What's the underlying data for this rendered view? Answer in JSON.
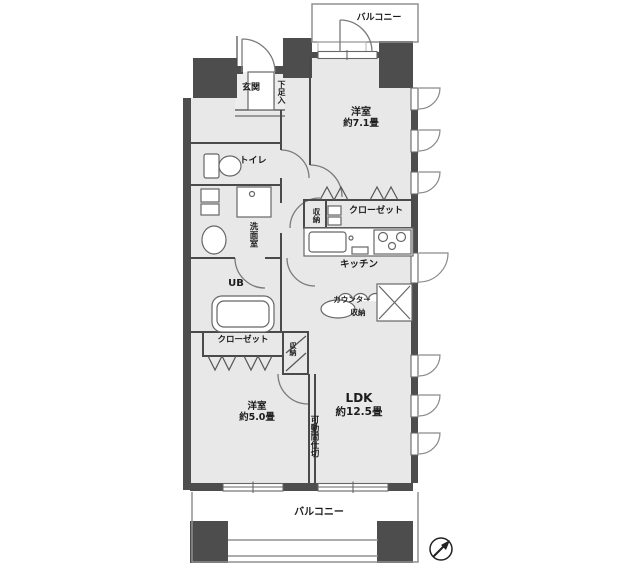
{
  "labels": {
    "balcony_top": "バルコニー",
    "balcony_bottom": "バルコニー",
    "entrance": "玄関",
    "shoe_cabinet": "下足入",
    "toilet": "トイレ",
    "washroom": "洗面室",
    "storage_kitchen": "収納",
    "closet_main": "クローゼット",
    "kitchen": "キッチン",
    "counter_storage_line1": "カウンター",
    "counter_storage_line2": "収納",
    "unit_bath": "UB",
    "closet_small_room": "クローゼット",
    "storage_small_room": "収納",
    "partition": "可動間仕切",
    "room_71_name": "洋室",
    "room_71_size": "約7.1畳",
    "room_50_name": "洋室",
    "room_50_size": "約5.0畳",
    "ldk_name": "LDK",
    "ldk_size": "約12.5畳"
  },
  "colors": {
    "wall": "#4d4d4d",
    "floor": "#e8e8e8",
    "interior_line": "#4a4a4a",
    "fixture_line": "#666666",
    "balcony_line": "#909090"
  }
}
